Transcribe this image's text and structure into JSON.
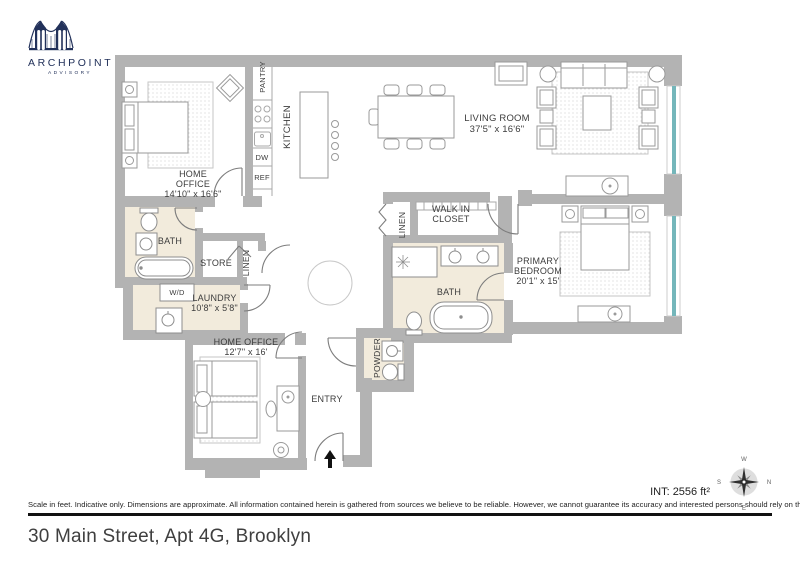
{
  "logo": {
    "brand": "ARCHPOINT",
    "tagline": "ADVISORY"
  },
  "plan": {
    "rooms": {
      "home_office_1": {
        "name": "HOME OFFICE",
        "dims": "14'10\" x 16'6\""
      },
      "kitchen": {
        "name": "KITCHEN"
      },
      "pantry": {
        "name": "PANTRY"
      },
      "dishwasher": {
        "name": "DW"
      },
      "refrigerator": {
        "name": "REF"
      },
      "living_room": {
        "name": "LIVING ROOM",
        "dims": "37'5\" x 16'6\""
      },
      "bath_1": {
        "name": "BATH"
      },
      "store": {
        "name": "STORE"
      },
      "linen_1": {
        "name": "LINEN"
      },
      "washer_dryer": {
        "name": "W/D"
      },
      "laundry": {
        "name": "LAUNDRY",
        "dims": "10'8\" x 5'8\""
      },
      "home_office_2": {
        "name": "HOME OFFICE",
        "dims": "12'7\" x 16'"
      },
      "entry": {
        "name": "ENTRY"
      },
      "powder": {
        "name": "POWDER"
      },
      "linen_2": {
        "name": "LINEN"
      },
      "walk_in_closet": {
        "name": "WALK IN CLOSET"
      },
      "primary_bedroom": {
        "name": "PRIMARY BEDROOM",
        "dims": "20'1\" x 15'"
      },
      "bath_2": {
        "name": "BATH"
      }
    },
    "compass": {
      "n": "N",
      "e": "E",
      "s": "S",
      "w": "W"
    },
    "interior_area": "INT: 2556 ft²"
  },
  "footer": {
    "disclaimer": "Scale in feet. Indicative only. Dimensions are approximate. All information contained herein is gathered from sources we believe to be reliable. However, we cannot guarantee its accuracy and interested persons should rely on their own inquiries .",
    "address": "30 Main Street, Apt 4G, Brooklyn"
  },
  "colors": {
    "wall": "#b3b3b3",
    "window": "#74b6ba",
    "tile_floor": "#f2ebdc",
    "brand_navy": "#22315a"
  }
}
